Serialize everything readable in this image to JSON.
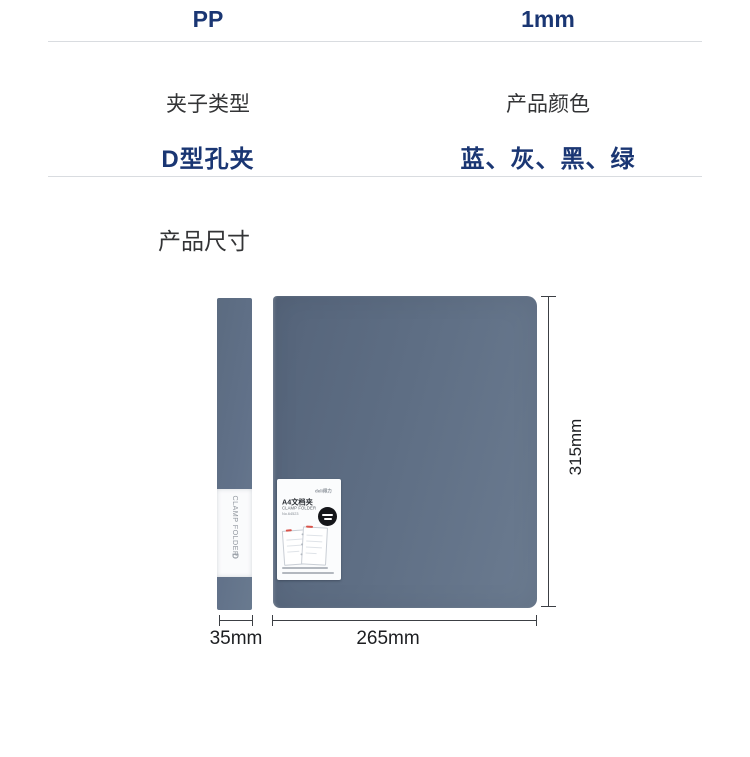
{
  "accent_color": "#1a3673",
  "folder_color": "#60708a",
  "spec_table": {
    "top_values": [
      "PP",
      "1mm"
    ],
    "labels": [
      "夹子类型",
      "产品颜色"
    ],
    "values": [
      "D型孔夹",
      "蓝、灰、黑、绿"
    ]
  },
  "section_title": "产品尺寸",
  "figure": {
    "spine_text": "CLAMP FOLDER",
    "spine_logo": "D",
    "front_label": {
      "brand": "deli得力",
      "title": "A4文档夹",
      "subtitle": "CLAMP FOLDER",
      "model": "No.64523"
    },
    "dimensions": {
      "height": "315mm",
      "spine_width": "35mm",
      "width": "265mm"
    }
  }
}
